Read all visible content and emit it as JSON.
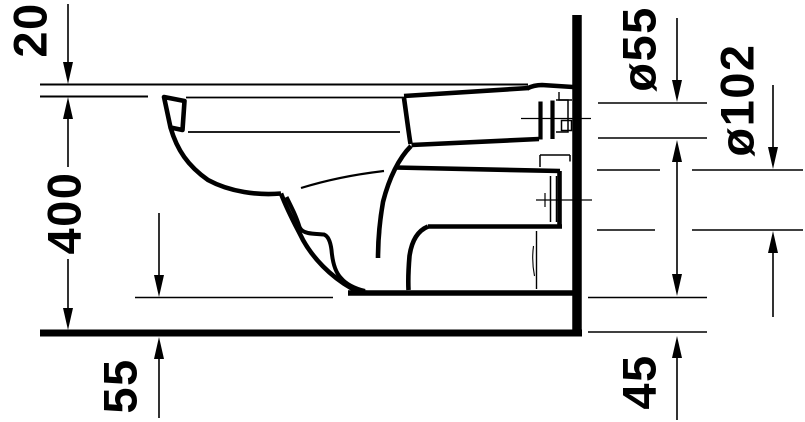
{
  "drawing": {
    "subject": "wall-hung-toilet-side-elevation-technical-drawing",
    "colors": {
      "line": "#000000",
      "background": "#ffffff"
    },
    "labels": {
      "seat_offset": "20",
      "rim_height": "400",
      "front_floor_gap": "55",
      "flush_pipe_diameter": "ø55",
      "outlet_diameter": "ø102",
      "rear_floor_gap": "45"
    }
  }
}
